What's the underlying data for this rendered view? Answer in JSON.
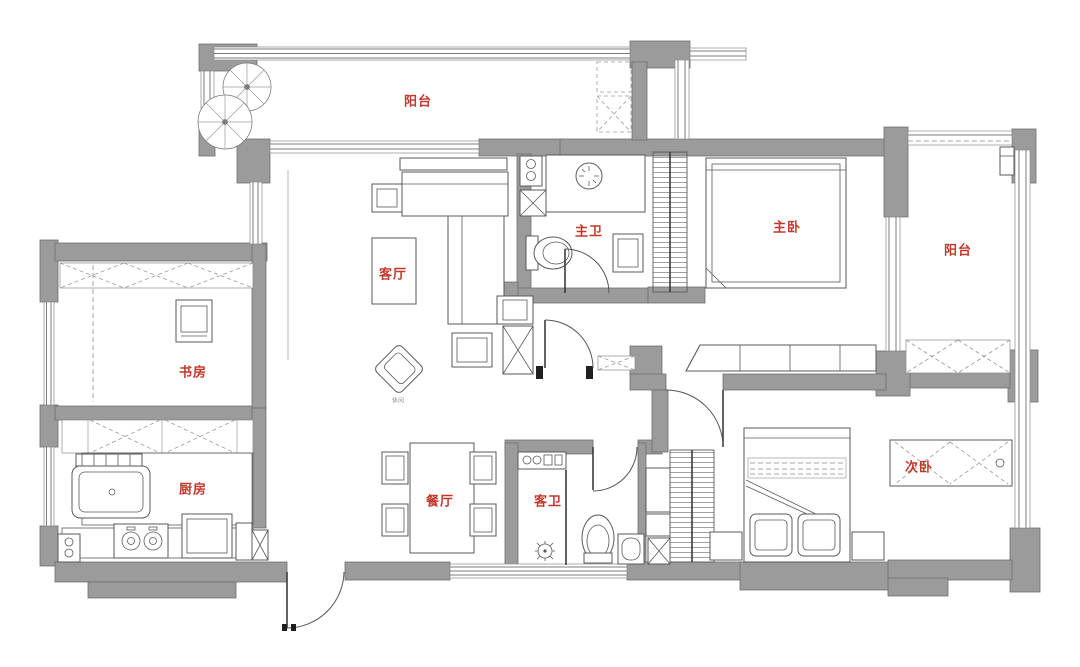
{
  "plan": {
    "type": "apartment-floor-plan",
    "colors": {
      "wall": "#9b9b9b",
      "wall_edge": "#6f6f6f",
      "furniture_line": "#5a5a5a",
      "label": "#c0392b",
      "background": "#ffffff"
    },
    "rooms": [
      {
        "id": "balcony-top",
        "label": "阳台"
      },
      {
        "id": "master-bath",
        "label": "主卫"
      },
      {
        "id": "master-bedroom",
        "label": "主卧"
      },
      {
        "id": "balcony-right",
        "label": "阳台"
      },
      {
        "id": "living-room",
        "label": "客厅"
      },
      {
        "id": "study",
        "label": "书房"
      },
      {
        "id": "kitchen",
        "label": "厨房"
      },
      {
        "id": "dining-room",
        "label": "餐厅"
      },
      {
        "id": "guest-bath",
        "label": "客卫"
      },
      {
        "id": "second-bedroom",
        "label": "次卧"
      }
    ],
    "annotations": [
      {
        "id": "leisure-chair-note",
        "label": "休闲"
      }
    ]
  }
}
